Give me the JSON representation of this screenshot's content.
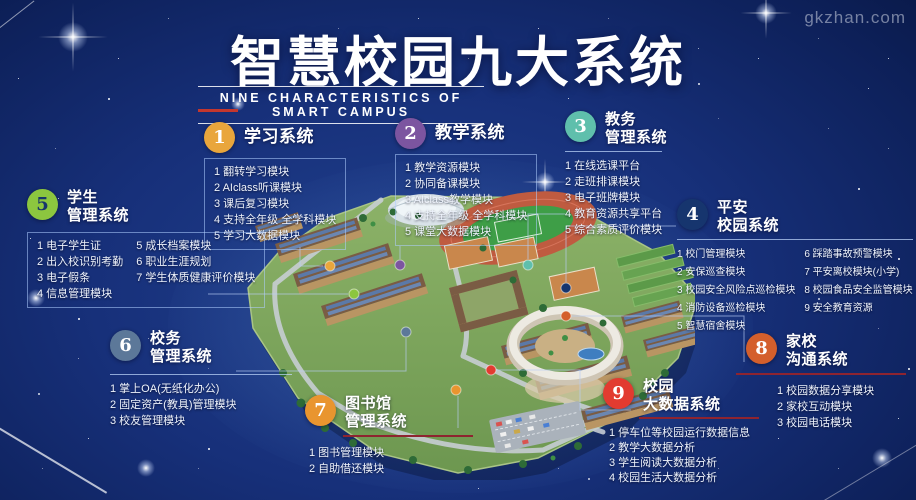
{
  "page": {
    "title": "智慧校园九大系统",
    "subtitle": "NINE CHARACTERISTICS OF SMART CAMPUS",
    "watermark": "gkzhan.com"
  },
  "colors": {
    "background": "#16307a",
    "title_text": "#ffffff",
    "accent_underline_red": "#8e2430",
    "subtitle_tick_red": "#c3372e",
    "list_border_blue": "#afcdff"
  },
  "systems": [
    {
      "number": "1",
      "title": "学习系统",
      "color": "#e9a63c",
      "number_color": "#ffffff",
      "items": [
        "1 翻转学习模块",
        "2 AIclass听课模块",
        "3 课后复习模块",
        "4 支持全年级 全学科模块",
        "5 学习大数据模块"
      ]
    },
    {
      "number": "2",
      "title": "教学系统",
      "color": "#7c55a0",
      "number_color": "#ffffff",
      "items": [
        "1 教学资源模块",
        "2 协同备课模块",
        "3 AIclass教学模块",
        "4 支持全年级 全学科模块",
        "5 课堂大数据模块"
      ]
    },
    {
      "number": "3",
      "title": "教务\n管理系统",
      "color": "#5fbfac",
      "number_color": "#ffffff",
      "items": [
        "1 在线选课平台",
        "2 走班排课模块",
        "3 电子班牌模块",
        "4 教育资源共享平台",
        "5 综合素质评价模块"
      ]
    },
    {
      "number": "4",
      "title": "平安\n校园系统",
      "color": "#16356e",
      "number_color": "#ffffff",
      "items_col1": [
        "1 校门管理模块",
        "2 安保巡查模块",
        "3 校园安全风险点巡检模块",
        "4 消防设备巡检模块",
        "5 智慧宿舍模块"
      ],
      "items_col2": [
        "6 踩踏事故预警模块",
        "7 平安离校模块(小学)",
        "8 校园食品安全监管模块",
        "9 安全教育资源"
      ]
    },
    {
      "number": "5",
      "title": "学生\n管理系统",
      "color": "#8cc63f",
      "number_color": "#17356b",
      "items_col1": [
        "1 电子学生证",
        "2 出入校识别考勤",
        "3 电子假条",
        "4 信息管理模块"
      ],
      "items_col2": [
        "5 成长档案模块",
        "6 职业生涯规划",
        "7 学生体质健康评价模块"
      ]
    },
    {
      "number": "6",
      "title": "校务\n管理系统",
      "color": "#5c7899",
      "number_color": "#ffffff",
      "items": [
        "1 掌上OA(无纸化办公)",
        "2 固定资产(教具)管理模块",
        "3 校友管理模块"
      ]
    },
    {
      "number": "7",
      "title": "图书馆\n管理系统",
      "color": "#e9952f",
      "number_color": "#ffffff",
      "items": [
        "1 图书管理模块",
        "2 自助借还模块"
      ]
    },
    {
      "number": "8",
      "title": "家校\n沟通系统",
      "color": "#d45f2c",
      "number_color": "#ffffff",
      "items": [
        "1 校园数据分享模块",
        "2 家校互动模块",
        "3 校园电话模块"
      ]
    },
    {
      "number": "9",
      "title": "校园\n大数据系统",
      "color": "#e23b30",
      "number_color": "#ffffff",
      "items": [
        "1 停车位等校园运行数据信息",
        "2 教学大数据分析",
        "3 学生阅读大数据分析",
        "4 校园生活大数据分析"
      ]
    }
  ]
}
